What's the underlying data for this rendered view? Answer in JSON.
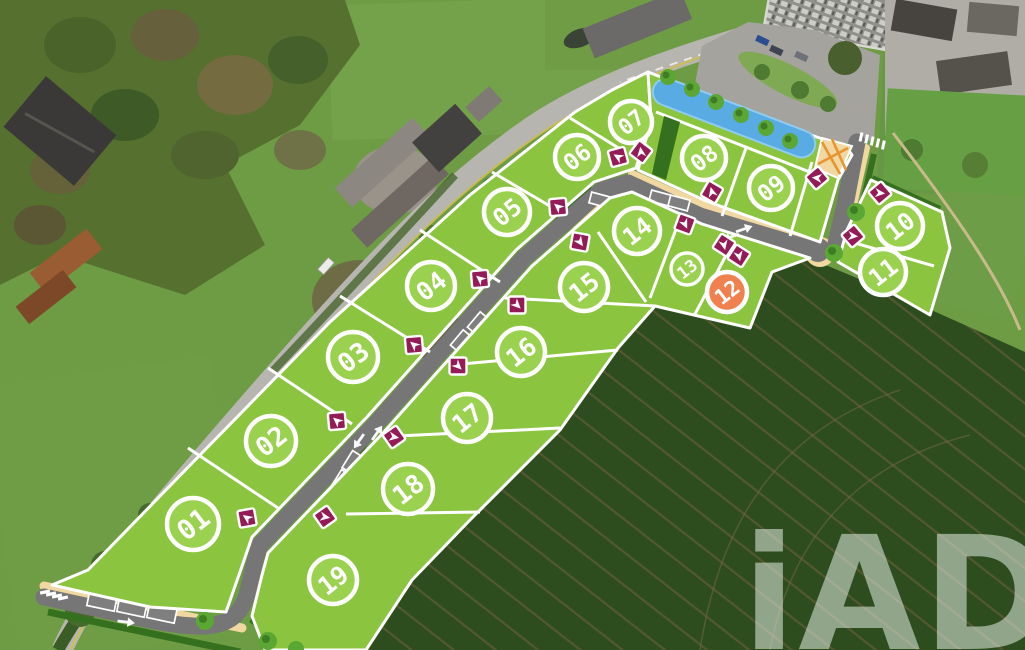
{
  "watermark": {
    "text": "iAD"
  },
  "colors": {
    "lot_green": "#8bc43e",
    "lot_circle_fill": "#9ad14e",
    "lot_reserved": "#f0814f",
    "marker_magenta": "#951b57",
    "water_blue": "#58abe3",
    "road_grey": "#767676",
    "sidewalk_beige": "#f1d7a0",
    "hedge_green": "#35701f",
    "outline_white": "#ffffff"
  },
  "development": {
    "label_rotation": -38,
    "lots": [
      {
        "id": "01",
        "status": "available",
        "x": 193,
        "y": 524,
        "r": 26
      },
      {
        "id": "02",
        "status": "available",
        "x": 271,
        "y": 441,
        "r": 25
      },
      {
        "id": "03",
        "status": "available",
        "x": 353,
        "y": 357,
        "r": 25
      },
      {
        "id": "04",
        "status": "available",
        "x": 431,
        "y": 286,
        "r": 24
      },
      {
        "id": "05",
        "status": "available",
        "x": 507,
        "y": 212,
        "r": 23
      },
      {
        "id": "06",
        "status": "available",
        "x": 577,
        "y": 157,
        "r": 22
      },
      {
        "id": "07",
        "status": "available",
        "x": 631,
        "y": 122,
        "r": 21
      },
      {
        "id": "08",
        "status": "available",
        "x": 704,
        "y": 158,
        "r": 22
      },
      {
        "id": "09",
        "status": "available",
        "x": 771,
        "y": 188,
        "r": 22
      },
      {
        "id": "10",
        "status": "available",
        "x": 900,
        "y": 226,
        "r": 23
      },
      {
        "id": "11",
        "status": "available",
        "x": 883,
        "y": 272,
        "r": 23
      },
      {
        "id": "12",
        "status": "reserved",
        "x": 727,
        "y": 292,
        "r": 20
      },
      {
        "id": "13",
        "status": "available",
        "x": 687,
        "y": 269,
        "r": 16
      },
      {
        "id": "14",
        "status": "available",
        "x": 637,
        "y": 231,
        "r": 23
      },
      {
        "id": "15",
        "status": "available",
        "x": 584,
        "y": 287,
        "r": 24
      },
      {
        "id": "16",
        "status": "available",
        "x": 521,
        "y": 352,
        "r": 24
      },
      {
        "id": "17",
        "status": "available",
        "x": 467,
        "y": 418,
        "r": 24
      },
      {
        "id": "18",
        "status": "available",
        "x": 408,
        "y": 489,
        "r": 25
      },
      {
        "id": "19",
        "status": "available",
        "x": 333,
        "y": 580,
        "r": 24
      }
    ],
    "access_markers": [
      {
        "lot": "01",
        "x": 247,
        "y": 518,
        "dir": -55
      },
      {
        "lot": "02",
        "x": 337,
        "y": 421,
        "dir": -50
      },
      {
        "lot": "03",
        "x": 414,
        "y": 345,
        "dir": -50
      },
      {
        "lot": "04",
        "x": 480,
        "y": 279,
        "dir": -50
      },
      {
        "lot": "05",
        "x": 558,
        "y": 207,
        "dir": -50
      },
      {
        "lot": "06",
        "x": 618,
        "y": 157,
        "dir": -60
      },
      {
        "lot": "07",
        "x": 641,
        "y": 152,
        "dir": -8
      },
      {
        "lot": "08",
        "x": 712,
        "y": 192,
        "dir": -15
      },
      {
        "lot": "09",
        "x": 817,
        "y": 178,
        "dir": -85
      },
      {
        "lot": "10",
        "x": 880,
        "y": 193,
        "dir": 95
      },
      {
        "lot": "11",
        "x": 853,
        "y": 236,
        "dir": 95
      },
      {
        "lot": "12",
        "x": 739,
        "y": 256,
        "dir": 168
      },
      {
        "lot": "13",
        "x": 724,
        "y": 245,
        "dir": 168
      },
      {
        "lot": "14",
        "x": 685,
        "y": 224,
        "dir": 155
      },
      {
        "lot": "15",
        "x": 580,
        "y": 242,
        "dir": 145
      },
      {
        "lot": "16",
        "x": 517,
        "y": 305,
        "dir": 135
      },
      {
        "lot": "17",
        "x": 458,
        "y": 366,
        "dir": 135
      },
      {
        "lot": "18",
        "x": 394,
        "y": 437,
        "dir": 100
      },
      {
        "lot": "19",
        "x": 325,
        "y": 517,
        "dir": 100
      }
    ],
    "road_arrows": [
      {
        "x": 359,
        "y": 441,
        "dir": 215
      },
      {
        "x": 377,
        "y": 433,
        "dir": 35
      },
      {
        "x": 731,
        "y": 237,
        "dir": 251
      },
      {
        "x": 744,
        "y": 229,
        "dir": 71
      },
      {
        "x": 126,
        "y": 622,
        "dir": 97
      }
    ]
  }
}
